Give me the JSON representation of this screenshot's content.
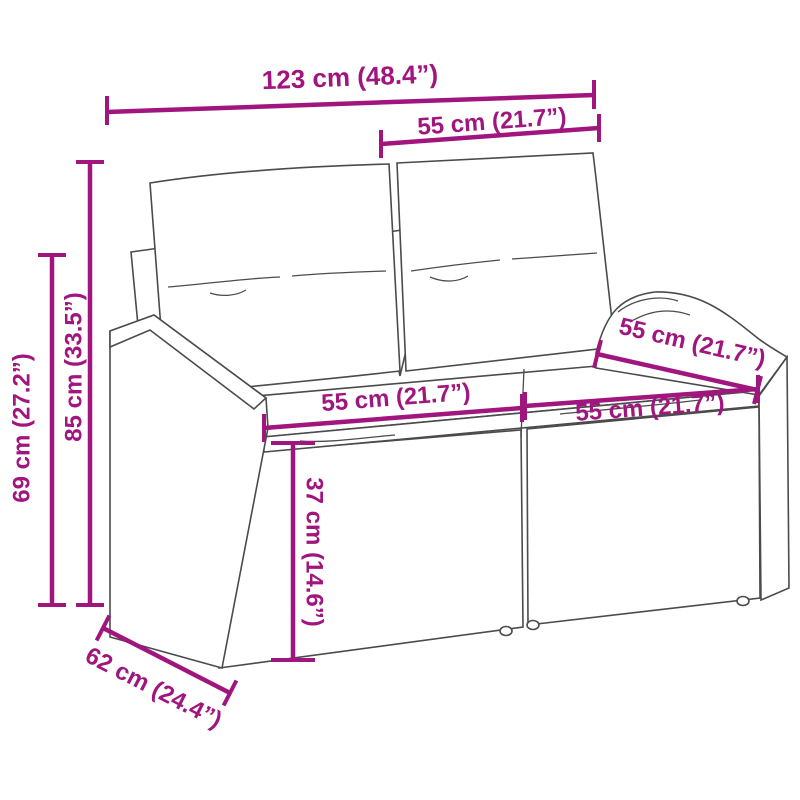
{
  "diagram": {
    "subject": "poly rattan 2-seater garden sofa with back and seat cushions",
    "accent_color": "#A1157F",
    "ink_color": "#4b4b4b",
    "labels": {
      "total_width": "123 cm (48.4”)",
      "backrest_width": "55 cm (21.7”)",
      "total_height": "85 cm (33.5”)",
      "armrest_height": "69 cm (27.2”)",
      "seat_width_left": "55 cm (21.7”)",
      "armrest_depth": "55 cm (21.7”)",
      "seat_width_right": "55 cm (21.7”)",
      "seat_height": "37 cm (14.6”)",
      "total_depth": "62 cm (24.4”)"
    }
  }
}
